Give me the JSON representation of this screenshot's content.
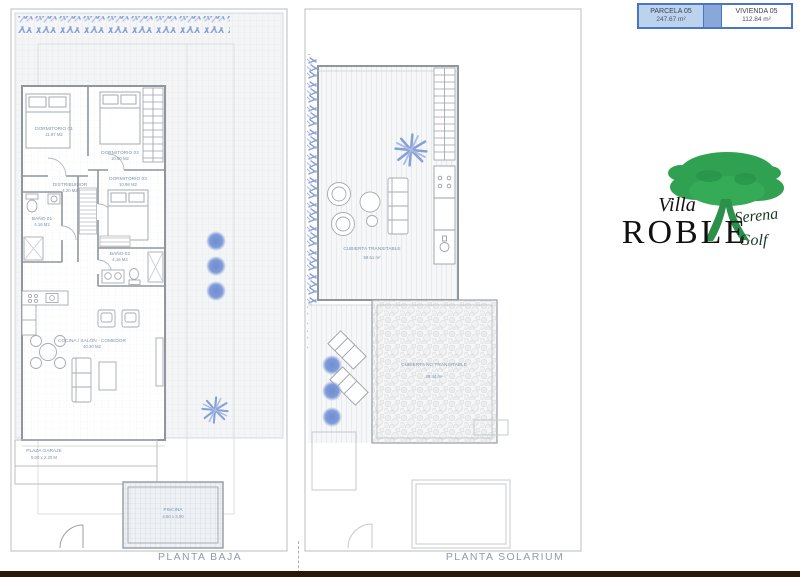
{
  "info_table": {
    "cells": [
      {
        "label": "PARCELA 05",
        "value": "247.67 m²"
      },
      {
        "label": "VIVIENDA 05",
        "value": "112.84 m²"
      }
    ]
  },
  "logo": {
    "villa": "Villa",
    "roble": "ROBLE",
    "serena": "Serena",
    "golf": "Golf"
  },
  "plans": {
    "baja": {
      "title": "PLANTA BAJA",
      "labels": {
        "dorm1": {
          "name": "DORMITORIO 01",
          "area": "11.97 M2"
        },
        "dorm2": {
          "name": "DORMITORIO 02",
          "area": "10.80 M2"
        },
        "dorm3": {
          "name": "DORMITORIO 03",
          "area": "10.98 M2"
        },
        "distribuidor": {
          "name": "DISTRIBUIDOR",
          "area": "4.20 M2"
        },
        "bano1": {
          "name": "BAÑO 01",
          "area": "4.16 M2"
        },
        "bano2": {
          "name": "BAÑO 02",
          "area": "4.16 M2"
        },
        "salon": {
          "name": "COCINA / SALÓN - COMEDOR",
          "area": "40.30 M2"
        },
        "garaje": {
          "name": "PLAZA GARAJE",
          "area": "5.00 x 2.20 M"
        },
        "piscina": {
          "name": "PISCINA",
          "area": "4.60 x 3.00"
        }
      }
    },
    "solarium": {
      "title": "PLANTA SOLARIUM",
      "labels": {
        "transitable": {
          "name": "CUBIERTA TRANSITABLE",
          "area": "59.51 m²"
        },
        "no_transitable": {
          "name": "CUBIERTA NO TRANSITABLE",
          "area": "29.44 m²"
        }
      }
    }
  },
  "colors": {
    "accent_blue": "#4a74c4",
    "parcela_cell": "#bcd3ee",
    "table_gap": "#8aa7da",
    "vegetation_blue": "#7f9bd8",
    "tree_green": "#2fa150",
    "label_blue": "#7d93ad"
  }
}
